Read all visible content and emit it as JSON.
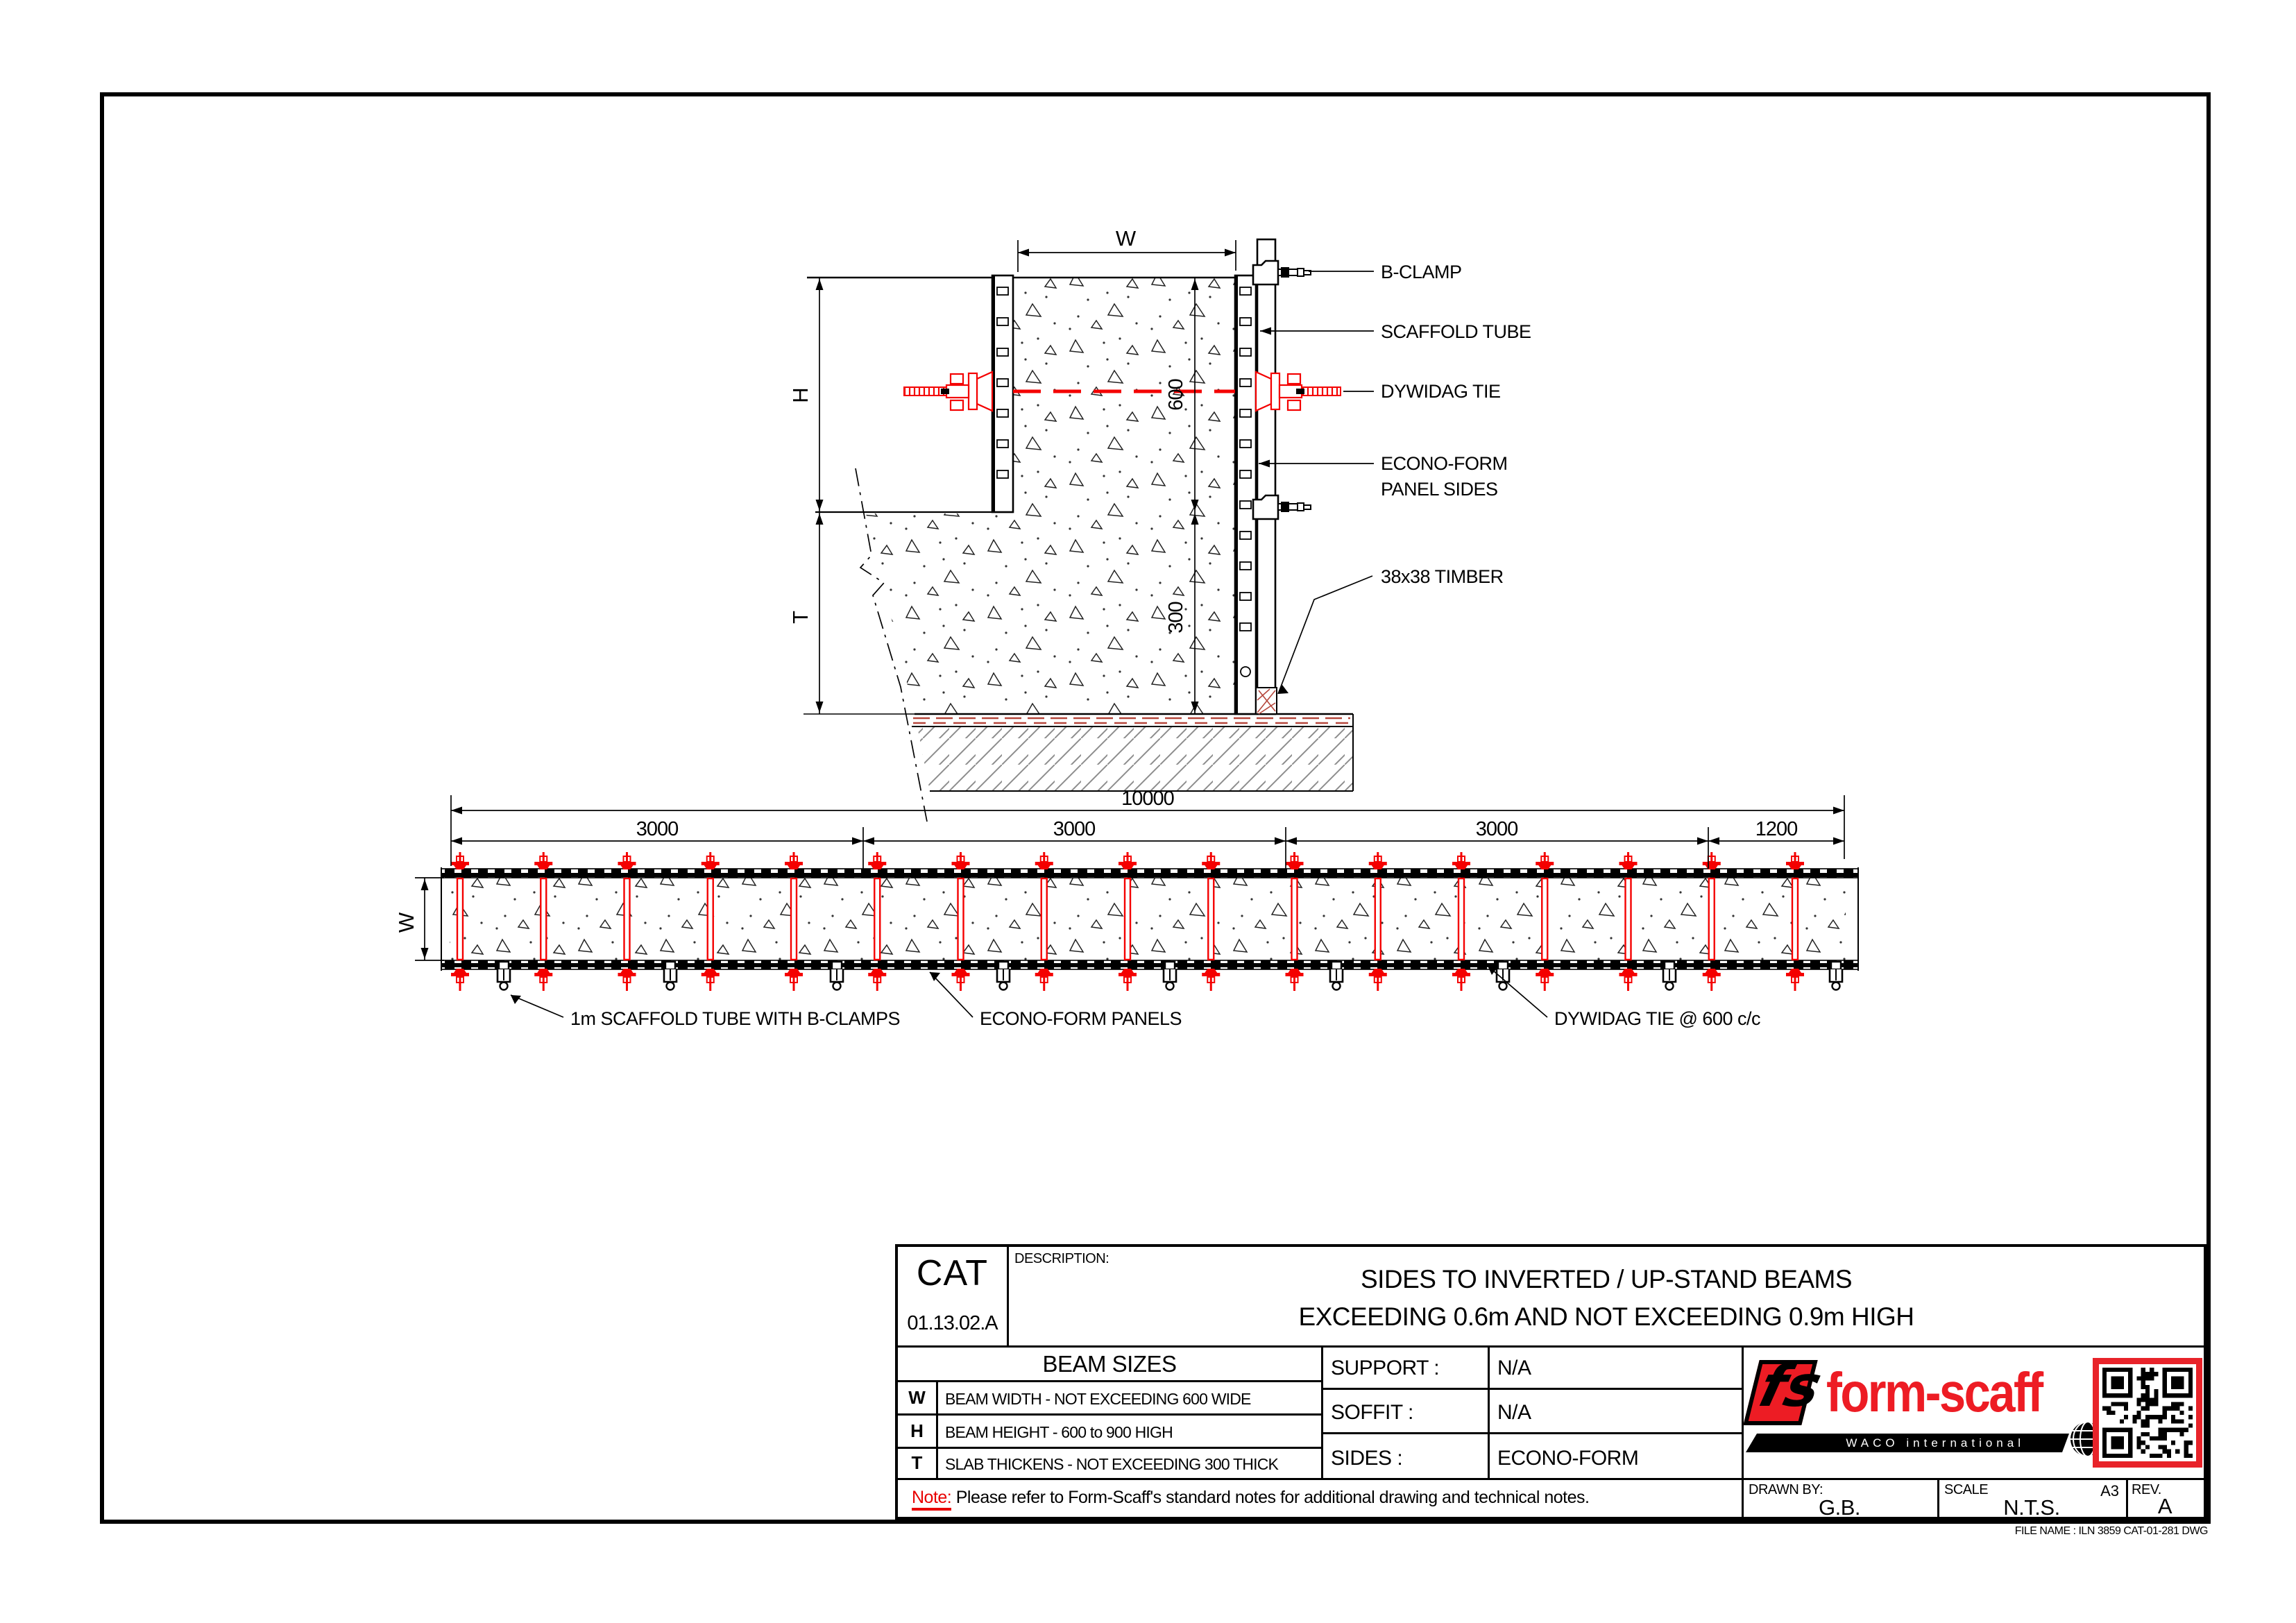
{
  "cross_section": {
    "dims": {
      "w": "W",
      "h": "H",
      "t": "T",
      "d600": "600",
      "d300": "300"
    },
    "callouts": {
      "b_clamp": "B-CLAMP",
      "scaffold_tube": "SCAFFOLD TUBE",
      "dywidag_tie": "DYWIDAG TIE",
      "panel_line1": "ECONO-FORM",
      "panel_line2": "PANEL SIDES",
      "timber": "38x38 TIMBER"
    }
  },
  "plan": {
    "dims": {
      "overall": "10000",
      "seg1": "3000",
      "seg2": "3000",
      "seg3": "3000",
      "seg4": "1200",
      "w": "W"
    },
    "callouts": {
      "tube": "1m SCAFFOLD TUBE WITH B-CLAMPS",
      "panels": "ECONO-FORM PANELS",
      "tie": "DYWIDAG TIE @ 600 c/c"
    }
  },
  "title_block": {
    "cat_label": "CAT",
    "cat_number": "01.13.02.A",
    "description_label": "DESCRIPTION:",
    "title_line1": "SIDES TO INVERTED / UP-STAND BEAMS",
    "title_line2": "EXCEEDING 0.6m AND NOT EXCEEDING 0.9m HIGH",
    "beam_sizes": {
      "header": "BEAM SIZES",
      "rows": [
        {
          "key": "W",
          "desc": "BEAM WIDTH - NOT EXCEEDING 600 WIDE"
        },
        {
          "key": "H",
          "desc": "BEAM HEIGHT - 600 to 900 HIGH"
        },
        {
          "key": "T",
          "desc": "SLAB THICKENS - NOT EXCEEDING 300 THICK"
        }
      ]
    },
    "specs": [
      {
        "label": "SUPPORT :",
        "value": "N/A"
      },
      {
        "label": "SOFFIT :",
        "value": "N/A"
      },
      {
        "label": "SIDES :",
        "value": "ECONO-FORM"
      }
    ],
    "note_label": "Note:",
    "note_text": " Please refer to Form-Scaff's standard notes for additional drawing and technical notes.",
    "drawn_by_label": "DRAWN BY:",
    "drawn_by_value": "G.B.",
    "scale_label": "SCALE",
    "scale_value": "N.T.S.",
    "paper_size": "A3",
    "rev_label": "REV.",
    "rev_value": "A",
    "file_name": "FILE NAME : ILN 3859 CAT-01-281 DWG",
    "logo": {
      "mark": "fs",
      "brand": "form-scaff",
      "sub": "WACO international"
    }
  },
  "colors": {
    "tie_red": "#f40000",
    "logo_red": "#ed1c24",
    "note_red": "#e80000",
    "hatch_grey": "#8d8d8d",
    "bed_red": "#b5473c"
  }
}
